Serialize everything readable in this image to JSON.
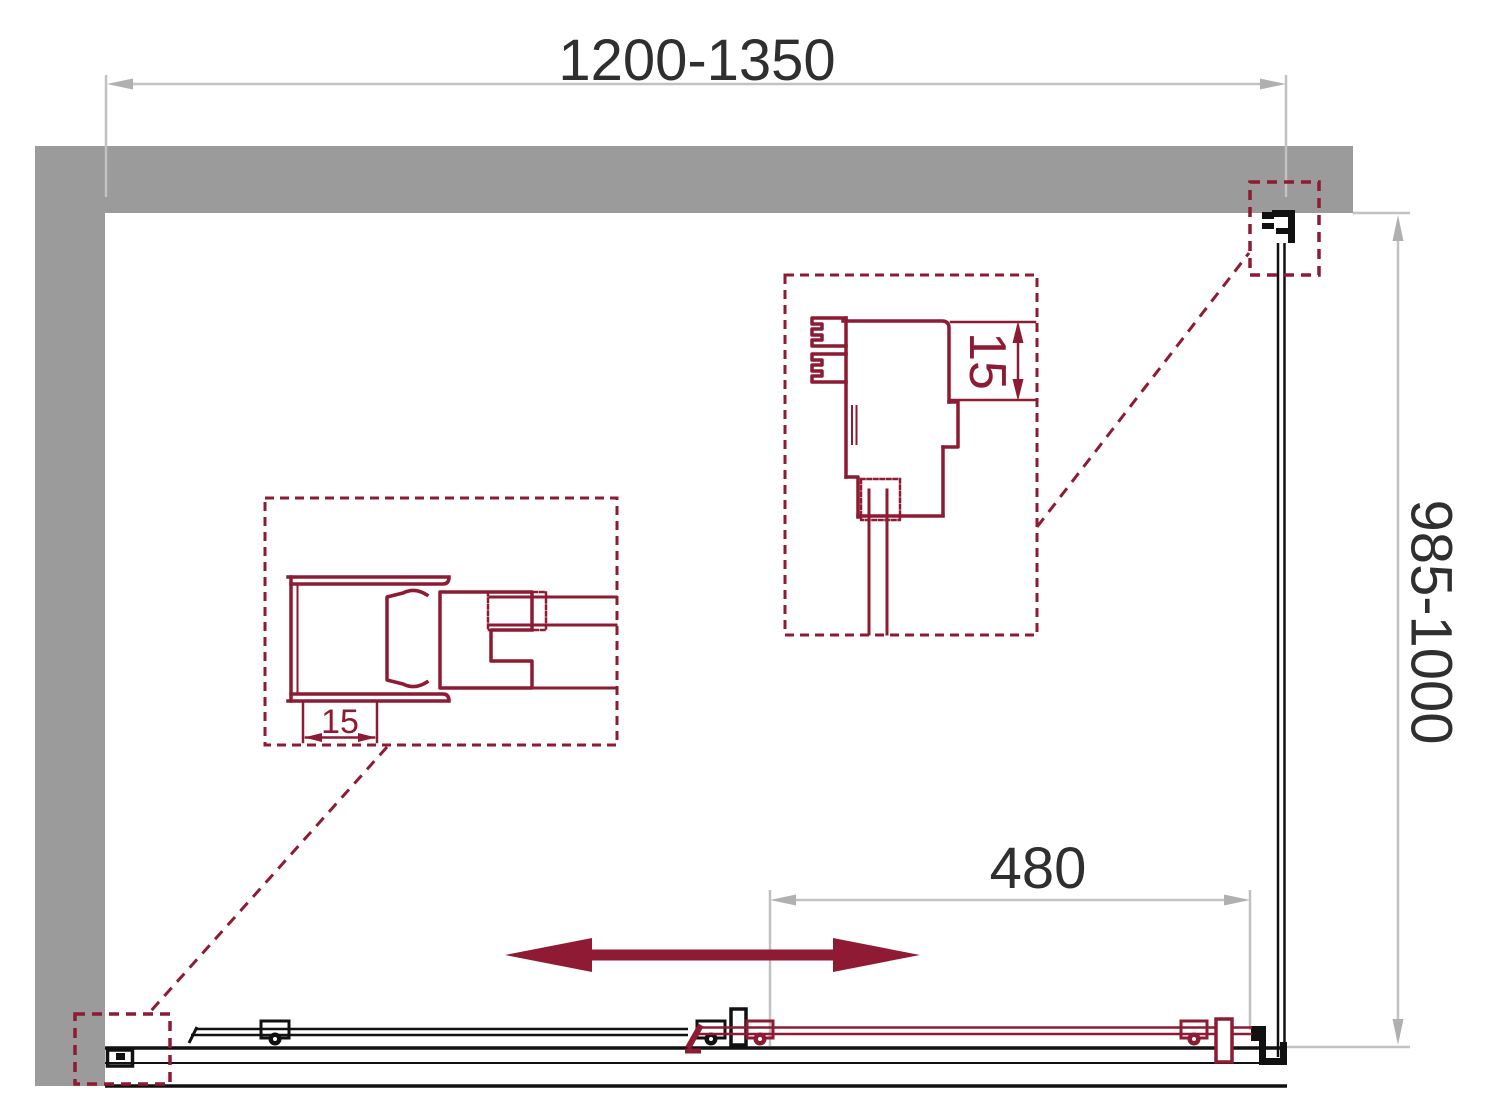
{
  "page": {
    "title": "Shower enclosure dimension drawing"
  },
  "dimensions": {
    "width_range": "1200-1350",
    "depth_range": "985-1000",
    "opening_width": "480",
    "detail_right_adjust": "15",
    "detail_left_adjust": "15"
  },
  "colors": {
    "wall": "#9b9b9b",
    "dimension_lines": "#c2c2c2",
    "dimension_arrows": "#b0b0b0",
    "dimension_text": "#2f2f2f",
    "profile_maroon": "#8c1b33",
    "arrow_maroon": "#8e1b33",
    "frame_black": "#111111"
  }
}
